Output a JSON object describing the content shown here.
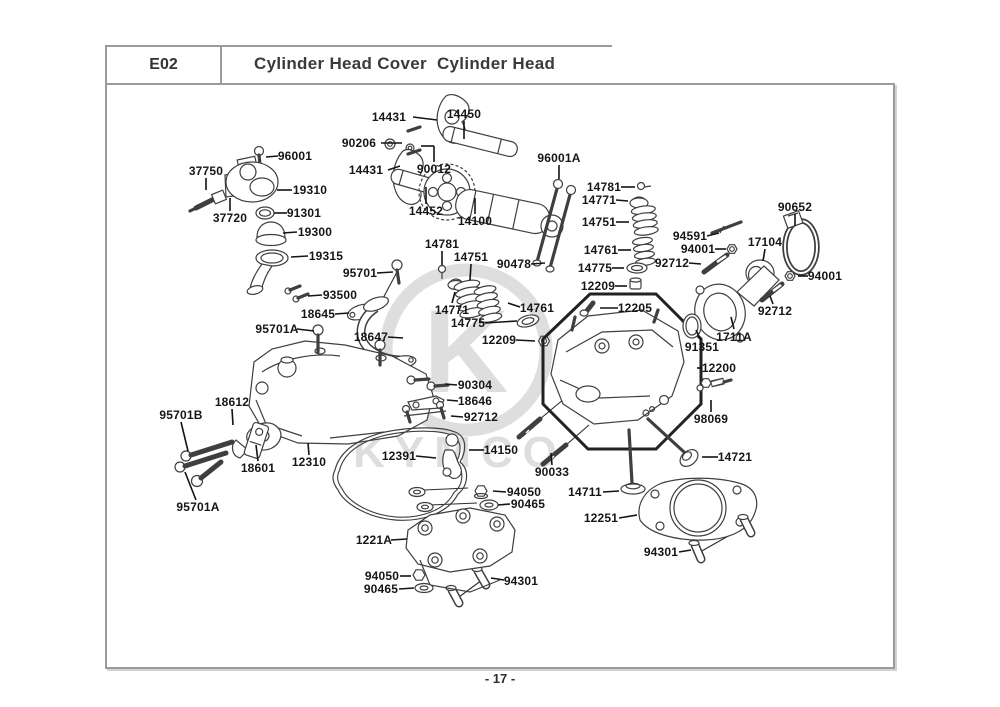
{
  "header": {
    "code": "E02",
    "title": "Cylinder Head Cover  Cylinder Head"
  },
  "footer": {
    "page_number": "- 17 -"
  },
  "watermark": {
    "logo_letter": "K",
    "brand": "KYMCO"
  },
  "colors": {
    "part_line": "#3f3f3f",
    "label_text": "#161616",
    "frame": "#9b9b9b",
    "watermark": "#dedede"
  },
  "labels": [
    {
      "num": "14431"
    },
    {
      "num": "14450"
    },
    {
      "num": "90206"
    },
    {
      "num": "14431"
    },
    {
      "num": "90012"
    },
    {
      "num": "14452"
    },
    {
      "num": "14100"
    },
    {
      "num": "96001A"
    },
    {
      "num": "96001"
    },
    {
      "num": "37750"
    },
    {
      "num": "19310"
    },
    {
      "num": "37720"
    },
    {
      "num": "91301"
    },
    {
      "num": "19300"
    },
    {
      "num": "19315"
    },
    {
      "num": "95701"
    },
    {
      "num": "93500"
    },
    {
      "num": "18645"
    },
    {
      "num": "95701A"
    },
    {
      "num": "18647"
    },
    {
      "num": "95701B"
    },
    {
      "num": "18612"
    },
    {
      "num": "18601"
    },
    {
      "num": "95701A"
    },
    {
      "num": "12310"
    },
    {
      "num": "12391"
    },
    {
      "num": "14781"
    },
    {
      "num": "14751"
    },
    {
      "num": "90478"
    },
    {
      "num": "14771"
    },
    {
      "num": "14761"
    },
    {
      "num": "14775"
    },
    {
      "num": "12209"
    },
    {
      "num": "14781"
    },
    {
      "num": "14771"
    },
    {
      "num": "14751"
    },
    {
      "num": "14761"
    },
    {
      "num": "14775"
    },
    {
      "num": "12209"
    },
    {
      "num": "12205"
    },
    {
      "num": "94591"
    },
    {
      "num": "94001"
    },
    {
      "num": "92712"
    },
    {
      "num": "90652"
    },
    {
      "num": "17104"
    },
    {
      "num": "94001"
    },
    {
      "num": "92712"
    },
    {
      "num": "1711A"
    },
    {
      "num": "91351"
    },
    {
      "num": "12200"
    },
    {
      "num": "98069"
    },
    {
      "num": "14721"
    },
    {
      "num": "90304"
    },
    {
      "num": "18646"
    },
    {
      "num": "92712"
    },
    {
      "num": "14150"
    },
    {
      "num": "90033"
    },
    {
      "num": "94050"
    },
    {
      "num": "90465"
    },
    {
      "num": "14711"
    },
    {
      "num": "12251"
    },
    {
      "num": "94301"
    },
    {
      "num": "1221A"
    },
    {
      "num": "94050"
    },
    {
      "num": "90465"
    },
    {
      "num": "94301"
    }
  ]
}
